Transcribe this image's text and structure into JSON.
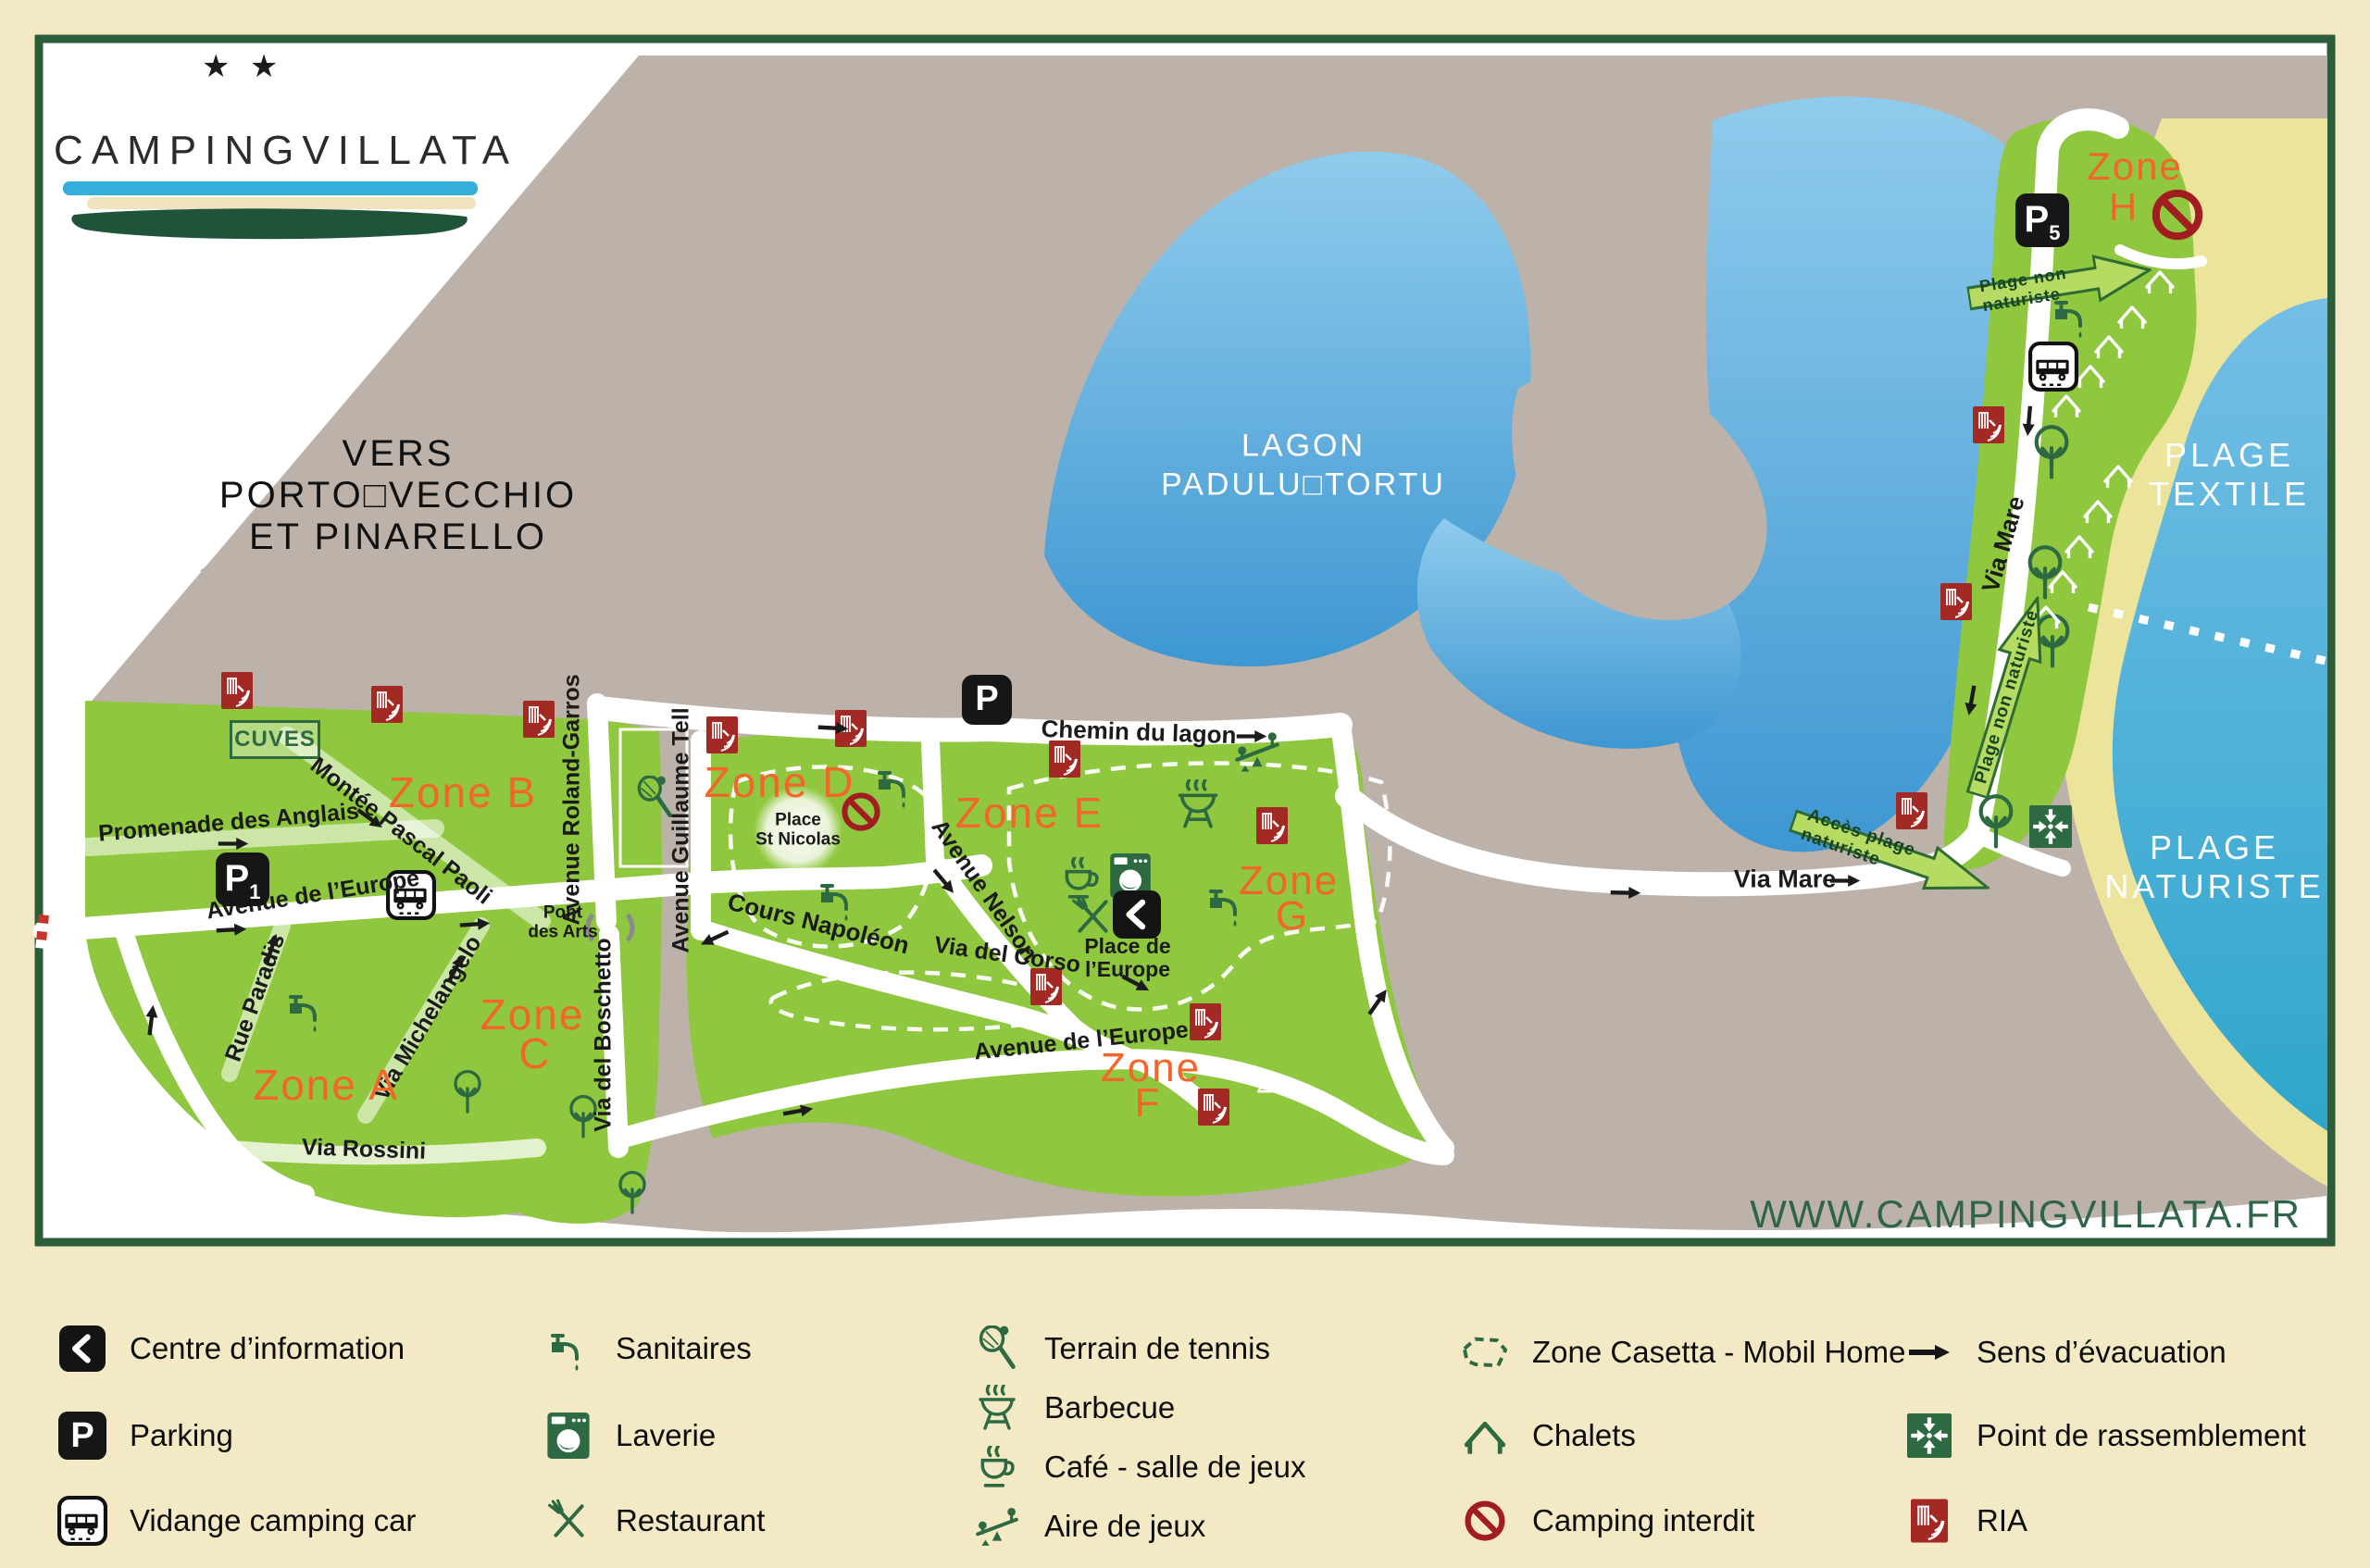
{
  "logo": {
    "stars": "★ ★",
    "left": "CAMPING",
    "right": "VILLATA"
  },
  "direction_note": {
    "line1": "VERS PORTO□VECCHIO",
    "line2": "ET PINARELLO"
  },
  "website": "WWW.CAMPINGVILLATA.FR",
  "map": {
    "lagoon": {
      "line1": "LAGON",
      "line2": "PADULU□TORTU"
    },
    "beach_textile": {
      "line1": "PLAGE",
      "line2": "TEXTILE"
    },
    "beach_naturiste": {
      "line1": "PLAGE",
      "line2": "NATURISTE"
    },
    "zones": {
      "a": "Zone A",
      "b": "Zone B",
      "c_line1": "Zone",
      "c_line2": "C",
      "d": "Zone D",
      "e": "Zone E",
      "f_line1": "Zone",
      "f_line2": "F",
      "g_line1": "Zone",
      "g_line2": "G",
      "h_line1": "Zone",
      "h_line2": "H"
    },
    "zone_f_number": "2",
    "streets": {
      "promenade": "Promenade des Anglais",
      "montee": "Montée Pascal Paoli",
      "roland": "Avenue Roland-Garros",
      "tell": "Avenue Guillaume Tell",
      "europe_upper": "Avenue de l’Europe",
      "paradis": "Rue Paradis",
      "michelangelo": "Via Michelangelo",
      "boschetto": "Via del Boschetto",
      "napoleon": "Cours Napoléon",
      "nelson": "Avenue Nelson",
      "corso": "Via del Corso",
      "europe_lower": "Avenue de l’Europe",
      "rossini": "Via Rossini",
      "chemin": "Chemin du lagon",
      "mare_h": "Via Mare",
      "mare_v": "Via Mare"
    },
    "places": {
      "cuves": "CUVES",
      "st_nicolas_1": "Place",
      "st_nicolas_2": "St Nicolas",
      "europe_1": "Place de",
      "europe_2": "l’Europe",
      "pont_1": "Pont",
      "pont_2": "des Arts"
    },
    "parkings": {
      "p1": {
        "letter": "P",
        "number": "1"
      },
      "p_lagon": {
        "letter": "P",
        "number": ""
      },
      "p5": {
        "letter": "P",
        "number": "5"
      }
    },
    "green_arrows": {
      "plage_non_naturiste_top": "Plage non naturiste",
      "plage_non_naturiste_road": "Plage non naturiste",
      "acces_naturiste": "Accès plage naturiste"
    }
  },
  "legend": {
    "items": [
      {
        "icon": "information-icon",
        "label": "Centre d’information"
      },
      {
        "icon": "parking-icon",
        "label": "Parking"
      },
      {
        "icon": "camper-drain-icon",
        "label": "Vidange camping car"
      },
      {
        "icon": "tap-icon",
        "label": "Sanitaires"
      },
      {
        "icon": "washing-machine-icon",
        "label": "Laverie"
      },
      {
        "icon": "restaurant-icon",
        "label": "Restaurant"
      },
      {
        "icon": "tennis-icon",
        "label": "Terrain de tennis"
      },
      {
        "icon": "barbecue-icon",
        "label": "Barbecue"
      },
      {
        "icon": "cafe-icon",
        "label": "Café - salle de jeux"
      },
      {
        "icon": "playground-icon",
        "label": "Aire de jeux"
      },
      {
        "icon": "casetta-zone-icon",
        "label": "Zone Casetta - Mobil Home"
      },
      {
        "icon": "chalet-icon",
        "label": "Chalets"
      },
      {
        "icon": "no-camping-icon",
        "label": "Camping interdit"
      },
      {
        "icon": "evacuation-arrow-icon",
        "label": "Sens d’évacuation"
      },
      {
        "icon": "assembly-point-icon",
        "label": "Point de rassemblement"
      },
      {
        "icon": "fire-hose-icon",
        "label": "RIA"
      }
    ]
  },
  "colors": {
    "accent_orange": "#F4652A",
    "map_green": "#8FC73E",
    "legend_green": "#2D6A42",
    "water_blue": "#4FA8DC",
    "sand": "#EDE49C",
    "land_gray": "#BCB2AA",
    "frame_green": "#2D5E3A",
    "ria_red": "#A32A24",
    "no_camping_red": "#A11D22",
    "background": "#F3EAC5"
  }
}
